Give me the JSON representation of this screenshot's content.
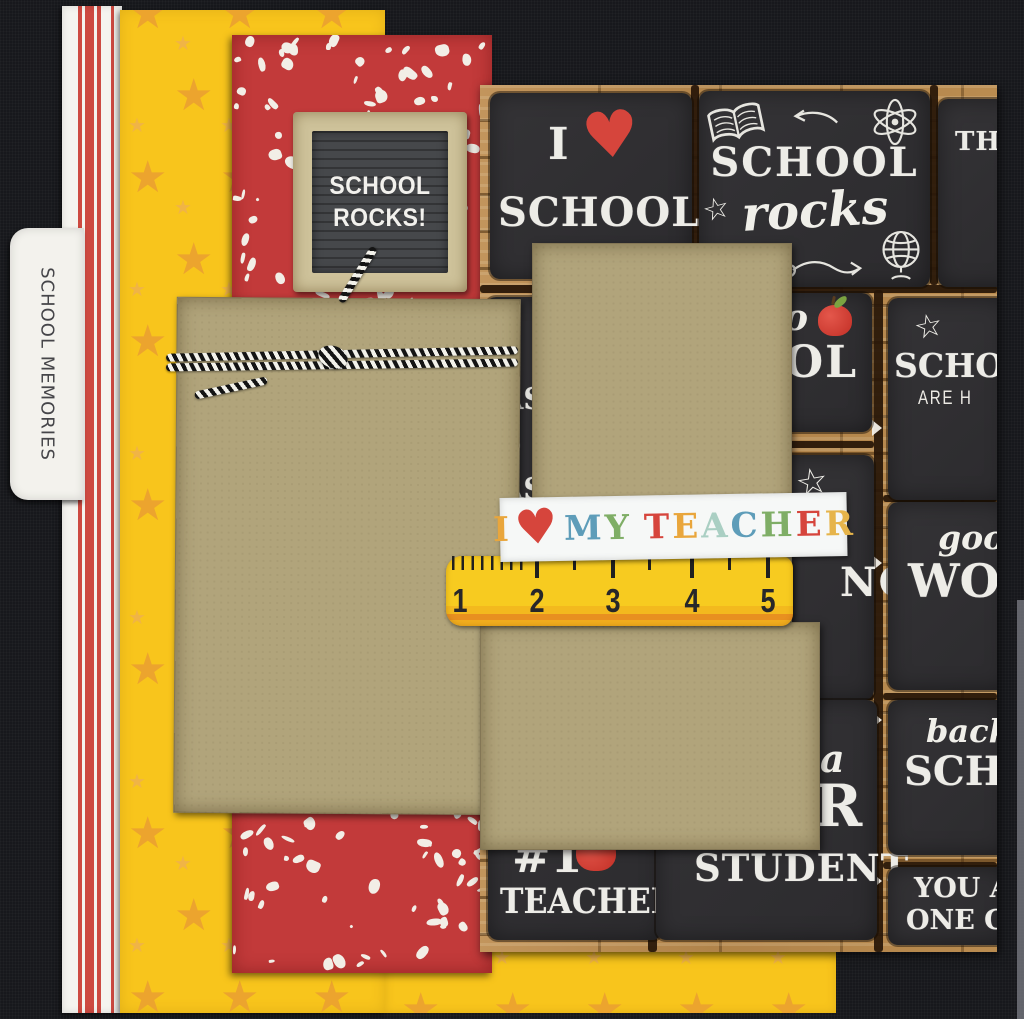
{
  "tab": {
    "label": "SCHOOL MEMORIES"
  },
  "letterboard": {
    "line1": "SCHOOL",
    "line2": "ROCKS!"
  },
  "chalk_cards": {
    "i_love_school": {
      "prefix": "I",
      "heart": "♥",
      "word": "SCHOOL"
    },
    "school_rocks": {
      "word1": "SCHOOL",
      "word2": "rocks"
    },
    "this_partial": {
      "text": "TH"
    },
    "smart_sliver_letters": [
      "S",
      "AS",
      "S",
      "AS"
    ],
    "to_school_partial": {
      "script": "o",
      "caps": "OL"
    },
    "school_days_partial": {
      "line1": "SCHOO",
      "line2": "ARE H"
    },
    "learning_partial": {
      "caps": "NG"
    },
    "good_work_partial": {
      "script": "good",
      "caps": "WOR"
    },
    "number_one_teacher": {
      "number": "#1",
      "word": "TEACHER"
    },
    "super_student_partial": {
      "script": "a",
      "cap": "R",
      "word": "STUDENT"
    },
    "back_to_school_partial": {
      "script": "back",
      "caps": "SCHO"
    },
    "one_cool_partial": {
      "line1": "YOU A",
      "line2": "ONE CO"
    }
  },
  "banner": {
    "letters": [
      {
        "ch": "I",
        "color": "#e9a63c"
      },
      {
        "ch": "♥",
        "color": "#d6453c",
        "heart": true
      },
      {
        "ch": "M",
        "color": "#5e9db9"
      },
      {
        "ch": "Y",
        "color": "#7fae66"
      },
      {
        "ch": " ",
        "space": true
      },
      {
        "ch": "T",
        "color": "#d6453c"
      },
      {
        "ch": "E",
        "color": "#e9a63c"
      },
      {
        "ch": "A",
        "color": "#aacfc3"
      },
      {
        "ch": "C",
        "color": "#5e9db9"
      },
      {
        "ch": "H",
        "color": "#7fae66"
      },
      {
        "ch": "E",
        "color": "#d6453c"
      },
      {
        "ch": "R",
        "color": "#e6b44a"
      }
    ]
  },
  "ruler": {
    "numbers": [
      "1",
      "2",
      "3",
      "4",
      "5"
    ]
  },
  "colors": {
    "canvas_black": "#17181c",
    "kraft_mat": "#b1a47b",
    "composition_red": "#c23a3a",
    "star_yellow": "#f8c51c",
    "star_orange": "#eca42e",
    "stripe_red": "#cd4a41",
    "wood_brown": "#b5854a",
    "chalkboard_dark": "#323134",
    "ruler_yellow": "#f7cb20",
    "heart_red": "#d6453c",
    "banner_white": "#f6f8f7"
  }
}
